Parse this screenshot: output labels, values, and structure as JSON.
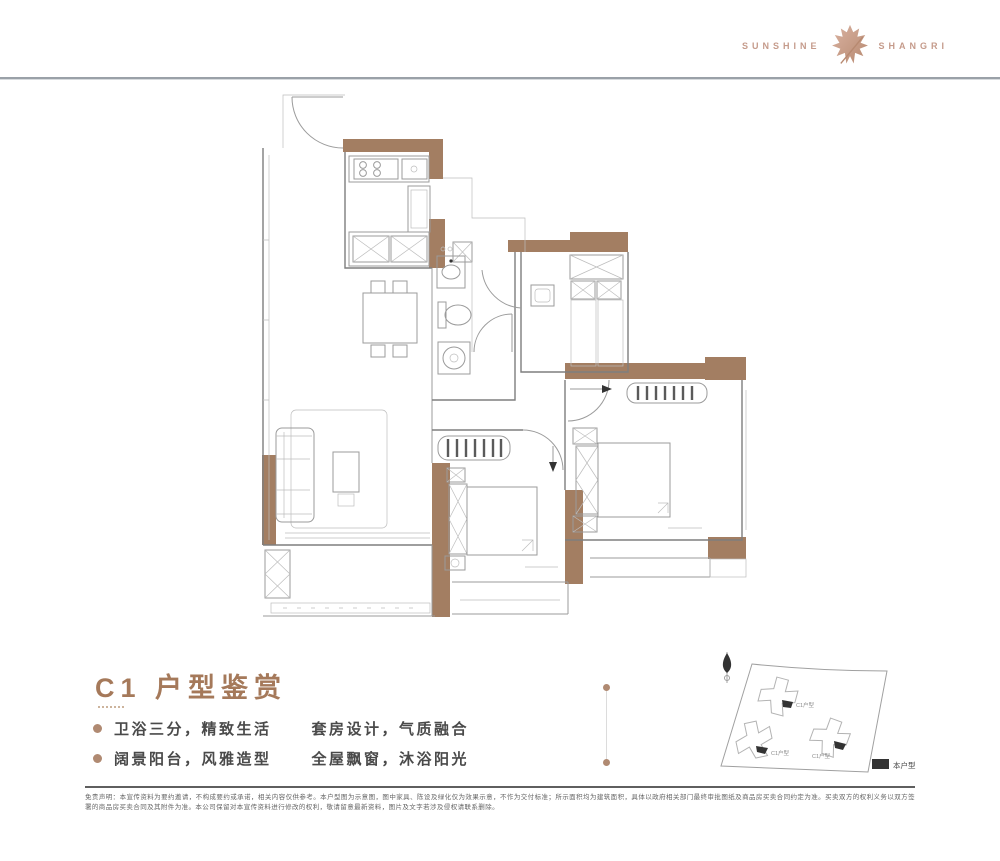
{
  "colors": {
    "wall_brown": "#a37e62",
    "accent_brown": "#a5795a",
    "bullet_dot": "#b08a72",
    "logo_rose": "#c59b8b",
    "plan_line": "#9b9b9b",
    "rule_gray": "#9aa1a8",
    "text_gray": "#4a4a4a",
    "disclaimer_gray": "#666666",
    "map_line": "#a0a0a0",
    "marker_black": "#222222"
  },
  "header": {
    "logo_left": "SUNSHINE",
    "logo_right": "SHANGRI",
    "logo_icon": "maple-leaf-icon"
  },
  "section": {
    "title": "C1 户型鉴赏",
    "bullets": [
      {
        "a": "卫浴三分，精致生活",
        "b": "套房设计，气质融合"
      },
      {
        "a": "阔景阳台，风雅造型",
        "b": "全屋飘窗，沐浴阳光"
      }
    ]
  },
  "sitemap": {
    "building_labels": [
      "C1户型",
      "C1户型",
      "C1户型"
    ],
    "legend_label": "本户型"
  },
  "disclaimer": "免责声明：本宣传资料为要约邀请，不构成要约或承诺，相关内容仅供参考。本户型图为示意图，图中家具、陈设及绿化仅为效果示意，不作为交付标准；所示面积均为建筑面积，具体以政府相关部门最终审批图纸及商品房买卖合同约定为准。买卖双方的权利义务以双方签署的商品房买卖合同及其附件为准。本公司保留对本宣传资料进行修改的权利，敬请留意最新资料，图片及文字若涉及侵权请联系删除。"
}
